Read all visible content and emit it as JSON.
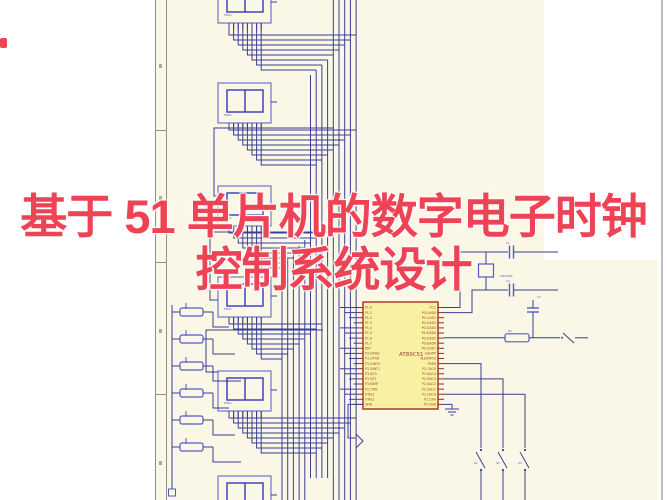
{
  "overlay": {
    "title_line1": "基于 51 单片机的数字电子时钟",
    "title_line2": "控制系统设计",
    "title_color": "#ee4354"
  },
  "schematic": {
    "colors": {
      "sheet": "#faf7e6",
      "wire": "#3a3e96",
      "component": "#5558c9",
      "chip_fill": "#f7f1a1",
      "chip_border": "#a33d2d",
      "chip_text": "#9a4433",
      "border_grey": "#8f8f8f"
    },
    "chip": {
      "name": "AT89C51",
      "left_pins": [
        "P1.0",
        "P1.1",
        "P1.2",
        "P1.3",
        "P1.4",
        "P1.5",
        "P1.6",
        "P1.7",
        "RST",
        "P3.0/RXD",
        "P3.1/TXD",
        "P3.2/INT0",
        "P3.3/INT1",
        "P3.4/T0",
        "P3.5/T1",
        "P3.6/WR",
        "P3.7/RD",
        "XTAL2",
        "XTAL1",
        "GND"
      ],
      "right_pins": [
        "VCC",
        "P0.0/AD0",
        "P0.1/AD1",
        "P0.2/AD2",
        "P0.3/AD3",
        "P0.4/AD4",
        "P0.5/AD5",
        "P0.6/AD6",
        "P0.7/AD7",
        "EA/VPP",
        "ALE/PROG",
        "PSEN",
        "P2.7/A15",
        "P2.6/A14",
        "P2.5/A13",
        "P2.4/A12",
        "P2.3/A11",
        "P2.2/A10",
        "P2.1/A9",
        "P2.0/A8"
      ]
    },
    "displays": {
      "label": "7SEG",
      "positions_y": [
        -17,
        83,
        186,
        277,
        371,
        476
      ]
    },
    "resistors": {
      "ref": "R",
      "positions_y": [
        312,
        339,
        366,
        393,
        420,
        447
      ]
    },
    "crystal": {
      "label": "CRYSTAL"
    },
    "capacitors": {
      "refs": [
        "C1",
        "C2",
        "C3"
      ]
    },
    "reset_resistor": {
      "ref": "R1"
    },
    "switches": {
      "refs": [
        "S1",
        "S2",
        "S3"
      ],
      "positions_x": [
        481,
        503,
        525
      ]
    }
  }
}
